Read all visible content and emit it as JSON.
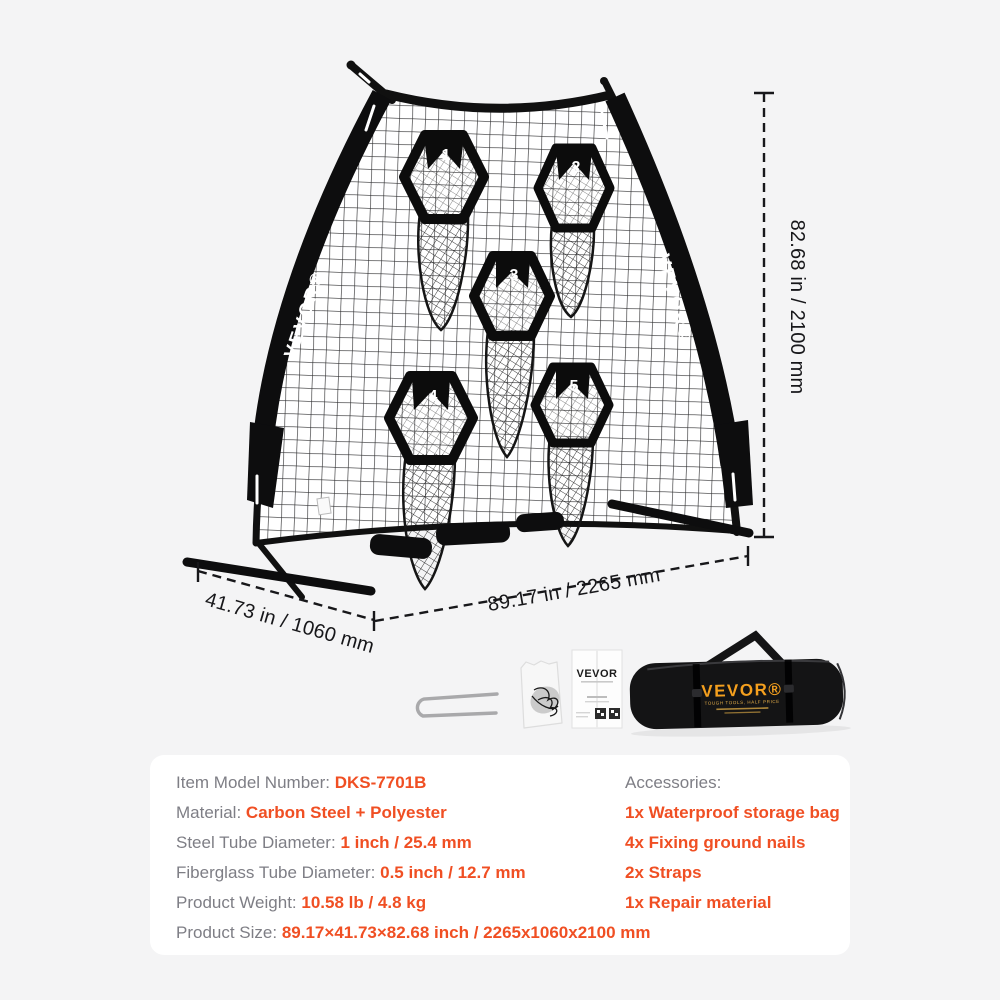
{
  "brand": "VEVOR",
  "scene": {
    "sleeve_brand": "VEVOR®",
    "dim_height": "82.68 in / 2100 mm",
    "dim_width": "89.17 in / 2265 mm",
    "dim_depth": "41.73 in / 1060 mm",
    "targets": {
      "t1": "1",
      "t2": "2",
      "t3": "3",
      "t4": "4",
      "t5": "5"
    },
    "manual_brand": "VEVOR",
    "bag": {
      "brand": "VEVOR®",
      "slogan": "TOUGH TOOLS, HALF PRICE"
    }
  },
  "specs": {
    "accent_color": "#f04f23",
    "label_color": "#7e7e85",
    "left": [
      {
        "label": "Item Model Number:",
        "value": "DKS-7701B"
      },
      {
        "label": "Material:",
        "value": "Carbon Steel + Polyester"
      },
      {
        "label": "Steel Tube Diameter:",
        "value": "1 inch / 25.4 mm"
      },
      {
        "label": "Fiberglass Tube Diameter:",
        "value": "0.5 inch / 12.7 mm"
      },
      {
        "label": "Product Weight:",
        "value": "10.58 lb / 4.8 kg"
      },
      {
        "label": "Product Size:",
        "value": "89.17×41.73×82.68 inch / 2265x1060x2100 mm"
      }
    ],
    "right": [
      {
        "label": "Accessories:",
        "value": ""
      },
      {
        "label": "",
        "value": "1x Waterproof storage bag"
      },
      {
        "label": "",
        "value": "4x Fixing ground nails"
      },
      {
        "label": "",
        "value": "2x Straps"
      },
      {
        "label": "",
        "value": "1x Repair material"
      }
    ]
  }
}
